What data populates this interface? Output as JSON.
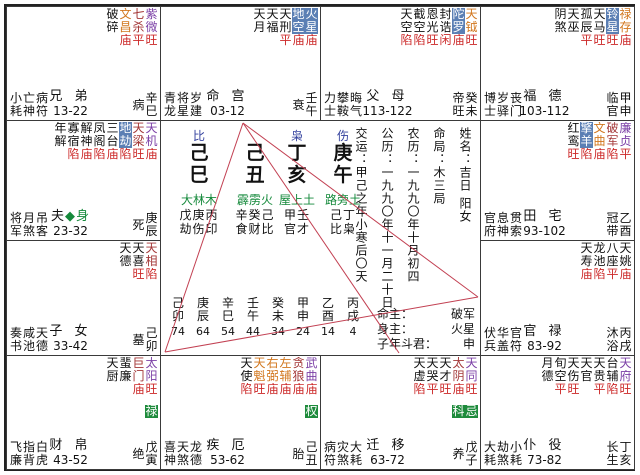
{
  "chart": {
    "colors": {
      "major_purple": "#7B3FA6",
      "major_red": "#A33636",
      "lucky_orange": "#D2771E",
      "malefic_bg": "#5B7FB4",
      "transform_bg": "#1E8B3C",
      "brightness_red": "#CC2929",
      "nayin_green": "#168A3C",
      "ten_god_blue": "#33419E",
      "aspect_line": "#C24052"
    },
    "palaces": [
      {
        "id": "si",
        "stars": [
          {
            "n": "破碎",
            "c": "k",
            "b": ""
          },
          {
            "n": "文昌",
            "c": "o",
            "b": "庙"
          },
          {
            "n": "七杀",
            "c": "r",
            "b": "平"
          },
          {
            "n": "紫微",
            "c": "p",
            "b": "旺"
          }
        ],
        "gods": [
          "小亡病",
          "耗神符"
        ],
        "palace": "兄 弟",
        "body": "",
        "range": "13-22",
        "stage": "病",
        "gz": "辛巳"
      },
      {
        "id": "wu",
        "stars": [
          {
            "n": "天月",
            "c": "k",
            "b": ""
          },
          {
            "n": "天福",
            "c": "k",
            "b": ""
          },
          {
            "n": "天刑",
            "c": "k",
            "b": "平"
          },
          {
            "n": "地空",
            "c": "s",
            "b": "庙"
          },
          {
            "n": "火星",
            "c": "s",
            "b": "庙"
          }
        ],
        "gods": [
          "青将岁",
          "龙星建"
        ],
        "palace": "命 宫",
        "body": "",
        "range": "03-12",
        "stage": "衰",
        "gz": "壬午"
      },
      {
        "id": "wei",
        "stars": [
          {
            "n": "天空",
            "c": "k",
            "b": "陷"
          },
          {
            "n": "截空",
            "c": "k",
            "b": "陷"
          },
          {
            "n": "恩光",
            "c": "k",
            "b": "旺"
          },
          {
            "n": "封诰",
            "c": "k",
            "b": "闲"
          },
          {
            "n": "陀罗",
            "c": "s",
            "b": "庙"
          },
          {
            "n": "天钺",
            "c": "o",
            "b": "旺"
          }
        ],
        "gods": [
          "力攀晦",
          "士鞍气"
        ],
        "palace": "父 母",
        "body": "",
        "range": "113-122",
        "stage": "帝旺",
        "gz": "癸未"
      },
      {
        "id": "shen",
        "stars": [
          {
            "n": "阴煞",
            "c": "k",
            "b": ""
          },
          {
            "n": "天巫",
            "c": "k",
            "b": ""
          },
          {
            "n": "孤辰",
            "c": "k",
            "b": "平"
          },
          {
            "n": "天马",
            "c": "k",
            "b": "旺"
          },
          {
            "n": "铃星",
            "c": "s",
            "b": "旺"
          },
          {
            "n": "禄存",
            "c": "o",
            "b": "庙"
          }
        ],
        "gods": [
          "博岁丧",
          "士驿门"
        ],
        "palace": "福 德",
        "body": "",
        "range": "103-112",
        "stage": "临官",
        "gz": "甲申"
      },
      {
        "id": "chen",
        "stars": [
          {
            "n": "年解",
            "c": "k",
            "b": ""
          },
          {
            "n": "寡宿",
            "c": "k",
            "b": "陷"
          },
          {
            "n": "解神",
            "c": "k",
            "b": "庙"
          },
          {
            "n": "凤阁",
            "c": "k",
            "b": "陷"
          },
          {
            "n": "三台",
            "c": "k",
            "b": "庙"
          },
          {
            "n": "地劫",
            "c": "s",
            "b": "陷"
          },
          {
            "n": "天梁",
            "c": "r",
            "b": "旺"
          },
          {
            "n": "天机",
            "c": "p",
            "b": "庙"
          }
        ],
        "gods": [
          "将月吊",
          "军煞客"
        ],
        "palace": "夫",
        "body": "◆身",
        "range": "23-32",
        "stage": "死",
        "gz": "庚辰"
      },
      {
        "id": "you",
        "stars": [
          {
            "n": "红鸾",
            "c": "k",
            "b": "旺"
          },
          {
            "n": "擎羊",
            "c": "s",
            "b": "陷"
          },
          {
            "n": "文曲",
            "c": "o",
            "b": "庙"
          },
          {
            "n": "破军",
            "c": "r",
            "b": "陷"
          },
          {
            "n": "廉贞",
            "c": "p",
            "b": "平"
          }
        ],
        "gods": [
          "官息贯",
          "府神索"
        ],
        "palace": "田 宅",
        "body": "",
        "range": "93-102",
        "stage": "冠带",
        "gz": "乙酉"
      },
      {
        "id": "mao",
        "stars": [
          {
            "n": "天德",
            "c": "k",
            "b": ""
          },
          {
            "n": "天喜",
            "c": "k",
            "b": "旺"
          },
          {
            "n": "天相",
            "c": "r",
            "b": "陷"
          }
        ],
        "gods": [
          "奏咸天",
          "书池德"
        ],
        "palace": "子 女",
        "body": "",
        "range": "33-42",
        "stage": "墓",
        "gz": "己卯"
      },
      {
        "id": "xu",
        "stars": [
          {
            "n": "天寿",
            "c": "k",
            "b": "庙"
          },
          {
            "n": "龙池",
            "c": "k",
            "b": "陷"
          },
          {
            "n": "八座",
            "c": "k",
            "b": "平"
          },
          {
            "n": "天姚",
            "c": "k",
            "b": "庙"
          }
        ],
        "gods": [
          "伏华官",
          "兵盖符"
        ],
        "palace": "官 禄",
        "body": "",
        "range": "83-92",
        "stage": "沐浴",
        "gz": "丙戌"
      },
      {
        "id": "yin",
        "stars": [
          {
            "n": "天厨",
            "c": "k",
            "b": ""
          },
          {
            "n": "蜚廉",
            "c": "k",
            "b": ""
          },
          {
            "n": "巨门",
            "c": "r",
            "b": "庙"
          },
          {
            "n": "太阳",
            "c": "p",
            "b": "旺",
            "h": "禄"
          }
        ],
        "gods": [
          "飞指白",
          "廉背虎"
        ],
        "palace": "财 帛",
        "body": "",
        "range": "43-52",
        "stage": "绝",
        "gz": "戊寅"
      },
      {
        "id": "chou",
        "stars": [
          {
            "n": "天使",
            "c": "k",
            "b": "陷"
          },
          {
            "n": "天魁",
            "c": "o",
            "b": "旺"
          },
          {
            "n": "右弼",
            "c": "o",
            "b": "庙"
          },
          {
            "n": "左辅",
            "c": "o",
            "b": "庙"
          },
          {
            "n": "贪狼",
            "c": "r",
            "b": "庙"
          },
          {
            "n": "武曲",
            "c": "p",
            "b": "庙",
            "h": "权"
          }
        ],
        "gods": [
          "喜天龙",
          "神煞德"
        ],
        "palace": "疾 厄",
        "body": "",
        "range": "53-62",
        "stage": "胎",
        "gz": "己丑"
      },
      {
        "id": "zi",
        "stars": [
          {
            "n": "天虚",
            "c": "k",
            "b": "陷"
          },
          {
            "n": "天哭",
            "c": "k",
            "b": "平"
          },
          {
            "n": "天才",
            "c": "k",
            "b": "旺"
          },
          {
            "n": "太阴",
            "c": "r",
            "b": "庙",
            "h": "科"
          },
          {
            "n": "天同",
            "c": "p",
            "b": "旺",
            "h": "忌"
          }
        ],
        "gods": [
          "病灾大",
          "符煞耗"
        ],
        "palace": "迁 移",
        "body": "",
        "range": "63-72",
        "stage": "养",
        "gz": "戊子"
      },
      {
        "id": "hai",
        "stars": [
          {
            "n": "月德",
            "c": "k",
            "b": ""
          },
          {
            "n": "旬空",
            "c": "k",
            "b": "平"
          },
          {
            "n": "天伤",
            "c": "k",
            "b": "旺"
          },
          {
            "n": "天官",
            "c": "k",
            "b": ""
          },
          {
            "n": "天贵",
            "c": "k",
            "b": "平"
          },
          {
            "n": "台辅",
            "c": "k",
            "b": "陷"
          },
          {
            "n": "天府",
            "c": "p",
            "b": "旺"
          }
        ],
        "gods": [
          "大劫小",
          "耗煞耗"
        ],
        "palace": "仆 役",
        "body": "",
        "range": "73-82",
        "stage": "长生",
        "gz": "丁亥"
      }
    ],
    "center": {
      "pillars": [
        {
          "god": "比",
          "stem": "己",
          "branch": "巳",
          "nayin": "大林木",
          "hidden": "戊庚丙",
          "hgods": "劫伤印"
        },
        {
          "god": "",
          "stem": "己",
          "branch": "丑",
          "nayin": "霹雳火",
          "hidden": "辛癸己",
          "hgods": "食财比"
        },
        {
          "god": "枭",
          "stem": "丁",
          "branch": "亥",
          "nayin": "屋上土",
          "hidden": "甲壬",
          "hgods": "官才"
        },
        {
          "god": "伤",
          "stem": "庚",
          "branch": "午",
          "nayin": "路旁土",
          "hidden": "己丁",
          "hgods": "比枭"
        }
      ],
      "dayun": [
        {
          "gz": "己卯",
          "age": "74"
        },
        {
          "gz": "庚辰",
          "age": "64"
        },
        {
          "gz": "辛巳",
          "age": "54"
        },
        {
          "gz": "壬午",
          "age": "44"
        },
        {
          "gz": "癸未",
          "age": "34"
        },
        {
          "gz": "甲申",
          "age": "24"
        },
        {
          "gz": "乙酉",
          "age": "14"
        },
        {
          "gz": "丙戌",
          "age": "4"
        }
      ],
      "info": [
        "姓名：吉日 阳女",
        "命局：木三局",
        "农历：一九九〇年十月初四",
        "公历：一九九〇年十一月二十日",
        "交运：甲己之年小寒后〇天"
      ],
      "masters": [
        {
          "label": "命主：",
          "value": "破军"
        },
        {
          "label": "身主：",
          "value": "火星"
        },
        {
          "label": "子年斗君：",
          "value": "申"
        }
      ]
    }
  }
}
